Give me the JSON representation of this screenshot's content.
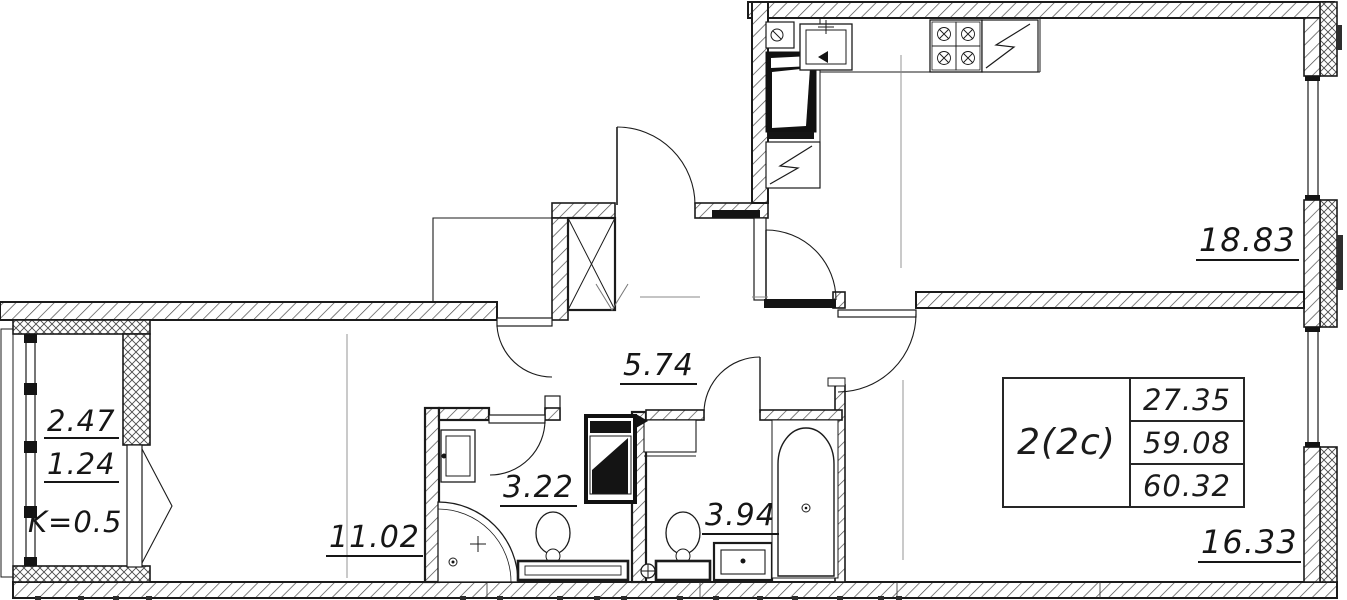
{
  "labels": {
    "kitchen_living": "18.83",
    "hallway": "5.74",
    "living_room": "11.02",
    "bathroom": "3.22",
    "toilet": "3.94",
    "bedroom": "16.33",
    "loggia_area": "2.47",
    "loggia_counted": "1.24",
    "loggia_coefficient": "K=0.5"
  },
  "summary": {
    "apartment_type": "2(2c)",
    "living_area": "27.35",
    "area_without_balcony": "59.08",
    "total_area": "60.32"
  },
  "colors": {
    "ink": "#1b1b1b",
    "background": "#ffffff"
  }
}
